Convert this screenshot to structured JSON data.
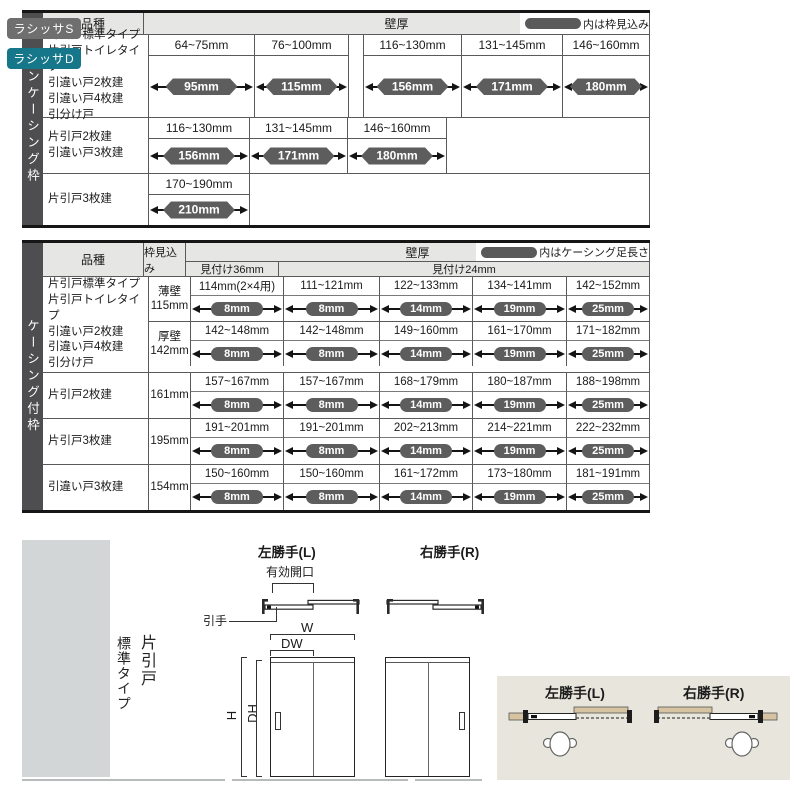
{
  "colors": {
    "side_bar": "#4e4e50",
    "header_band": "#e6e6e5",
    "capsule": "#5d5d5d",
    "badge_s": "#6f6f6f",
    "badge_d": "#157789",
    "left_panel": "#d3d6d6",
    "diagram_box": "#e7e5dc",
    "wall_tan": "#d6c3a2"
  },
  "table1": {
    "side_label": "ノンケーシング枠",
    "header": {
      "kind": "品種",
      "wall": "壁厚",
      "legend": "内は枠見込み"
    },
    "groups": [
      {
        "kinds": [
          "片引戸標準タイプ",
          "片引戸トイレタイプ",
          "引違い戸2枚建",
          "引違い戸4枚建",
          "引分け戸"
        ],
        "cells": [
          {
            "range": "64~75mm",
            "value": "95mm"
          },
          {
            "range": "76~100mm",
            "value": "115mm"
          },
          {
            "range": "116~130mm",
            "value": "156mm"
          },
          {
            "range": "131~145mm",
            "value": "171mm"
          },
          {
            "range": "146~160mm",
            "value": "180mm"
          }
        ]
      },
      {
        "kinds": [
          "片引戸2枚建",
          "引違い戸3枚建"
        ],
        "cells": [
          {
            "range": "116~130mm",
            "value": "156mm"
          },
          {
            "range": "131~145mm",
            "value": "171mm"
          },
          {
            "range": "146~160mm",
            "value": "180mm"
          }
        ]
      },
      {
        "kinds": [
          "片引戸3枚建"
        ],
        "cells": [
          {
            "range": "170~190mm",
            "value": "210mm"
          }
        ]
      }
    ]
  },
  "table2": {
    "side_label": "ケーシング付枠",
    "header": {
      "kind": "品種",
      "depth": "枠見込み",
      "wall": "壁厚",
      "legend": "内はケーシング足長さ",
      "sub36": "見付け36mm",
      "sub24": "見付け24mm"
    },
    "group1": {
      "kinds": [
        "片引戸標準タイプ",
        "片引戸トイレタイプ",
        "引違い戸2枚建",
        "引違い戸4枚建",
        "引分け戸"
      ],
      "rows": [
        {
          "depth_lines": [
            "薄壁",
            "115mm"
          ],
          "cells": [
            {
              "range": "114mm(2×4用)",
              "value": "8mm"
            },
            {
              "range": "111~121mm",
              "value": "8mm"
            },
            {
              "range": "122~133mm",
              "value": "14mm"
            },
            {
              "range": "134~141mm",
              "value": "19mm"
            },
            {
              "range": "142~152mm",
              "value": "25mm"
            }
          ]
        },
        {
          "depth_lines": [
            "厚壁",
            "142mm"
          ],
          "cells": [
            {
              "range": "142~148mm",
              "value": "8mm"
            },
            {
              "range": "142~148mm",
              "value": "8mm"
            },
            {
              "range": "149~160mm",
              "value": "14mm"
            },
            {
              "range": "161~170mm",
              "value": "19mm"
            },
            {
              "range": "171~182mm",
              "value": "25mm"
            }
          ]
        }
      ]
    },
    "rows": [
      {
        "kind": "片引戸2枚建",
        "depth": "161mm",
        "cells": [
          {
            "range": "157~167mm",
            "value": "8mm"
          },
          {
            "range": "157~167mm",
            "value": "8mm"
          },
          {
            "range": "168~179mm",
            "value": "14mm"
          },
          {
            "range": "180~187mm",
            "value": "19mm"
          },
          {
            "range": "188~198mm",
            "value": "25mm"
          }
        ]
      },
      {
        "kind": "片引戸3枚建",
        "depth": "195mm",
        "cells": [
          {
            "range": "191~201mm",
            "value": "8mm"
          },
          {
            "range": "191~201mm",
            "value": "8mm"
          },
          {
            "range": "202~213mm",
            "value": "14mm"
          },
          {
            "range": "214~221mm",
            "value": "19mm"
          },
          {
            "range": "222~232mm",
            "value": "25mm"
          }
        ]
      },
      {
        "kind": "引違い戸3枚建",
        "depth": "154mm",
        "cells": [
          {
            "range": "150~160mm",
            "value": "8mm"
          },
          {
            "range": "150~160mm",
            "value": "8mm"
          },
          {
            "range": "161~172mm",
            "value": "14mm"
          },
          {
            "range": "173~180mm",
            "value": "19mm"
          },
          {
            "range": "181~191mm",
            "value": "25mm"
          }
        ]
      }
    ]
  },
  "bottom": {
    "series": [
      {
        "label": "ラシッサS"
      },
      {
        "label": "ラシッサD"
      }
    ],
    "type_lines": [
      "片引戸",
      "標準タイプ"
    ],
    "plan_left_title": "左勝手(L)",
    "plan_right_title": "右勝手(R)",
    "opening_label": "有効開口",
    "pull_label": "引手",
    "dims": {
      "w": "W",
      "dw": "DW",
      "h": "H",
      "dh": "DH"
    },
    "box": {
      "left_title": "左勝手(L)",
      "right_title": "右勝手(R)"
    }
  }
}
